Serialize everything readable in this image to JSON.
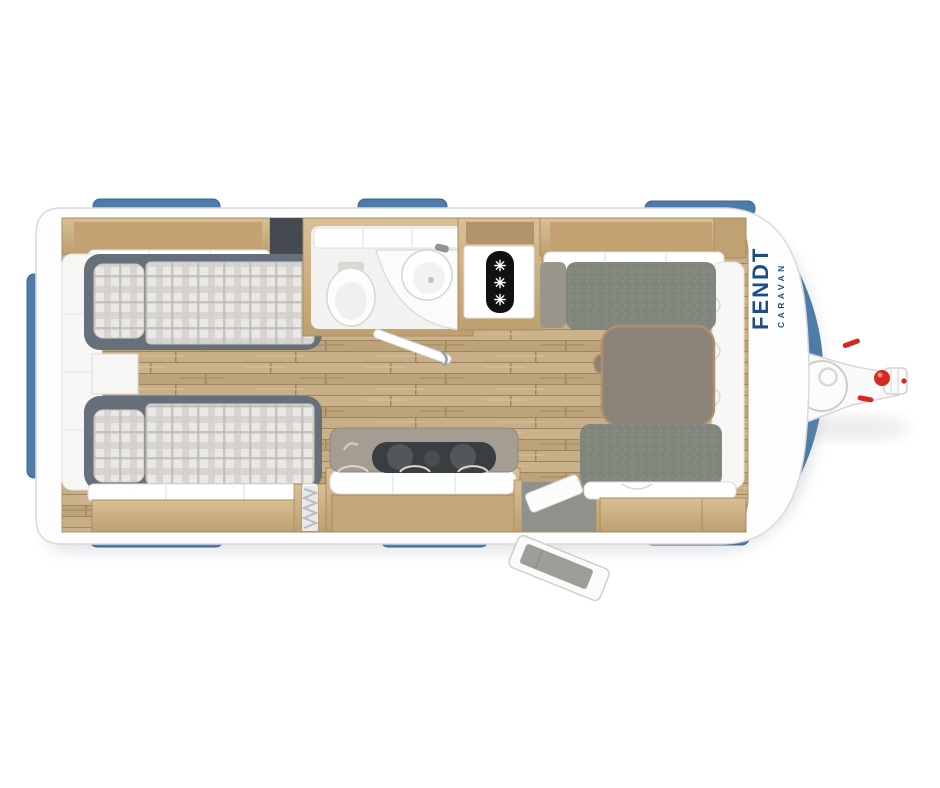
{
  "brand": {
    "name": "FENDT",
    "sub": "CARAVAN",
    "color": "#1c4d86"
  },
  "fridge": {
    "icon": "snowflake-icon",
    "glyph": "✳",
    "count": 3
  },
  "colors": {
    "window_blue": "#4e7ca9",
    "window_blue_dark": "#3c6690",
    "body_white": "#fdfdfd",
    "wall_stroke": "#d9d9d9",
    "wood_cabinet": "#cdb287",
    "wood_cabinet_dark": "#b1946a",
    "wood_floor": "#c5ab83",
    "bed_frame_gray": "#66707b",
    "cushion_gray": "#82877e",
    "table_top": "#8d8277",
    "hob_dark": "#3b3e41",
    "hitch_red": "#d6281e",
    "fridge_panel": "#111111"
  },
  "floorplan": {
    "vehicle": "caravan-top-view",
    "areas": [
      "rear-bedroom-twin-beds",
      "wardrobe-rear-wall",
      "bathroom-with-toilet-and-corner-sink",
      "refrigerator",
      "kitchen-with-hob",
      "entry-door-open",
      "front-dinette-with-table",
      "tow-hitch"
    ]
  }
}
